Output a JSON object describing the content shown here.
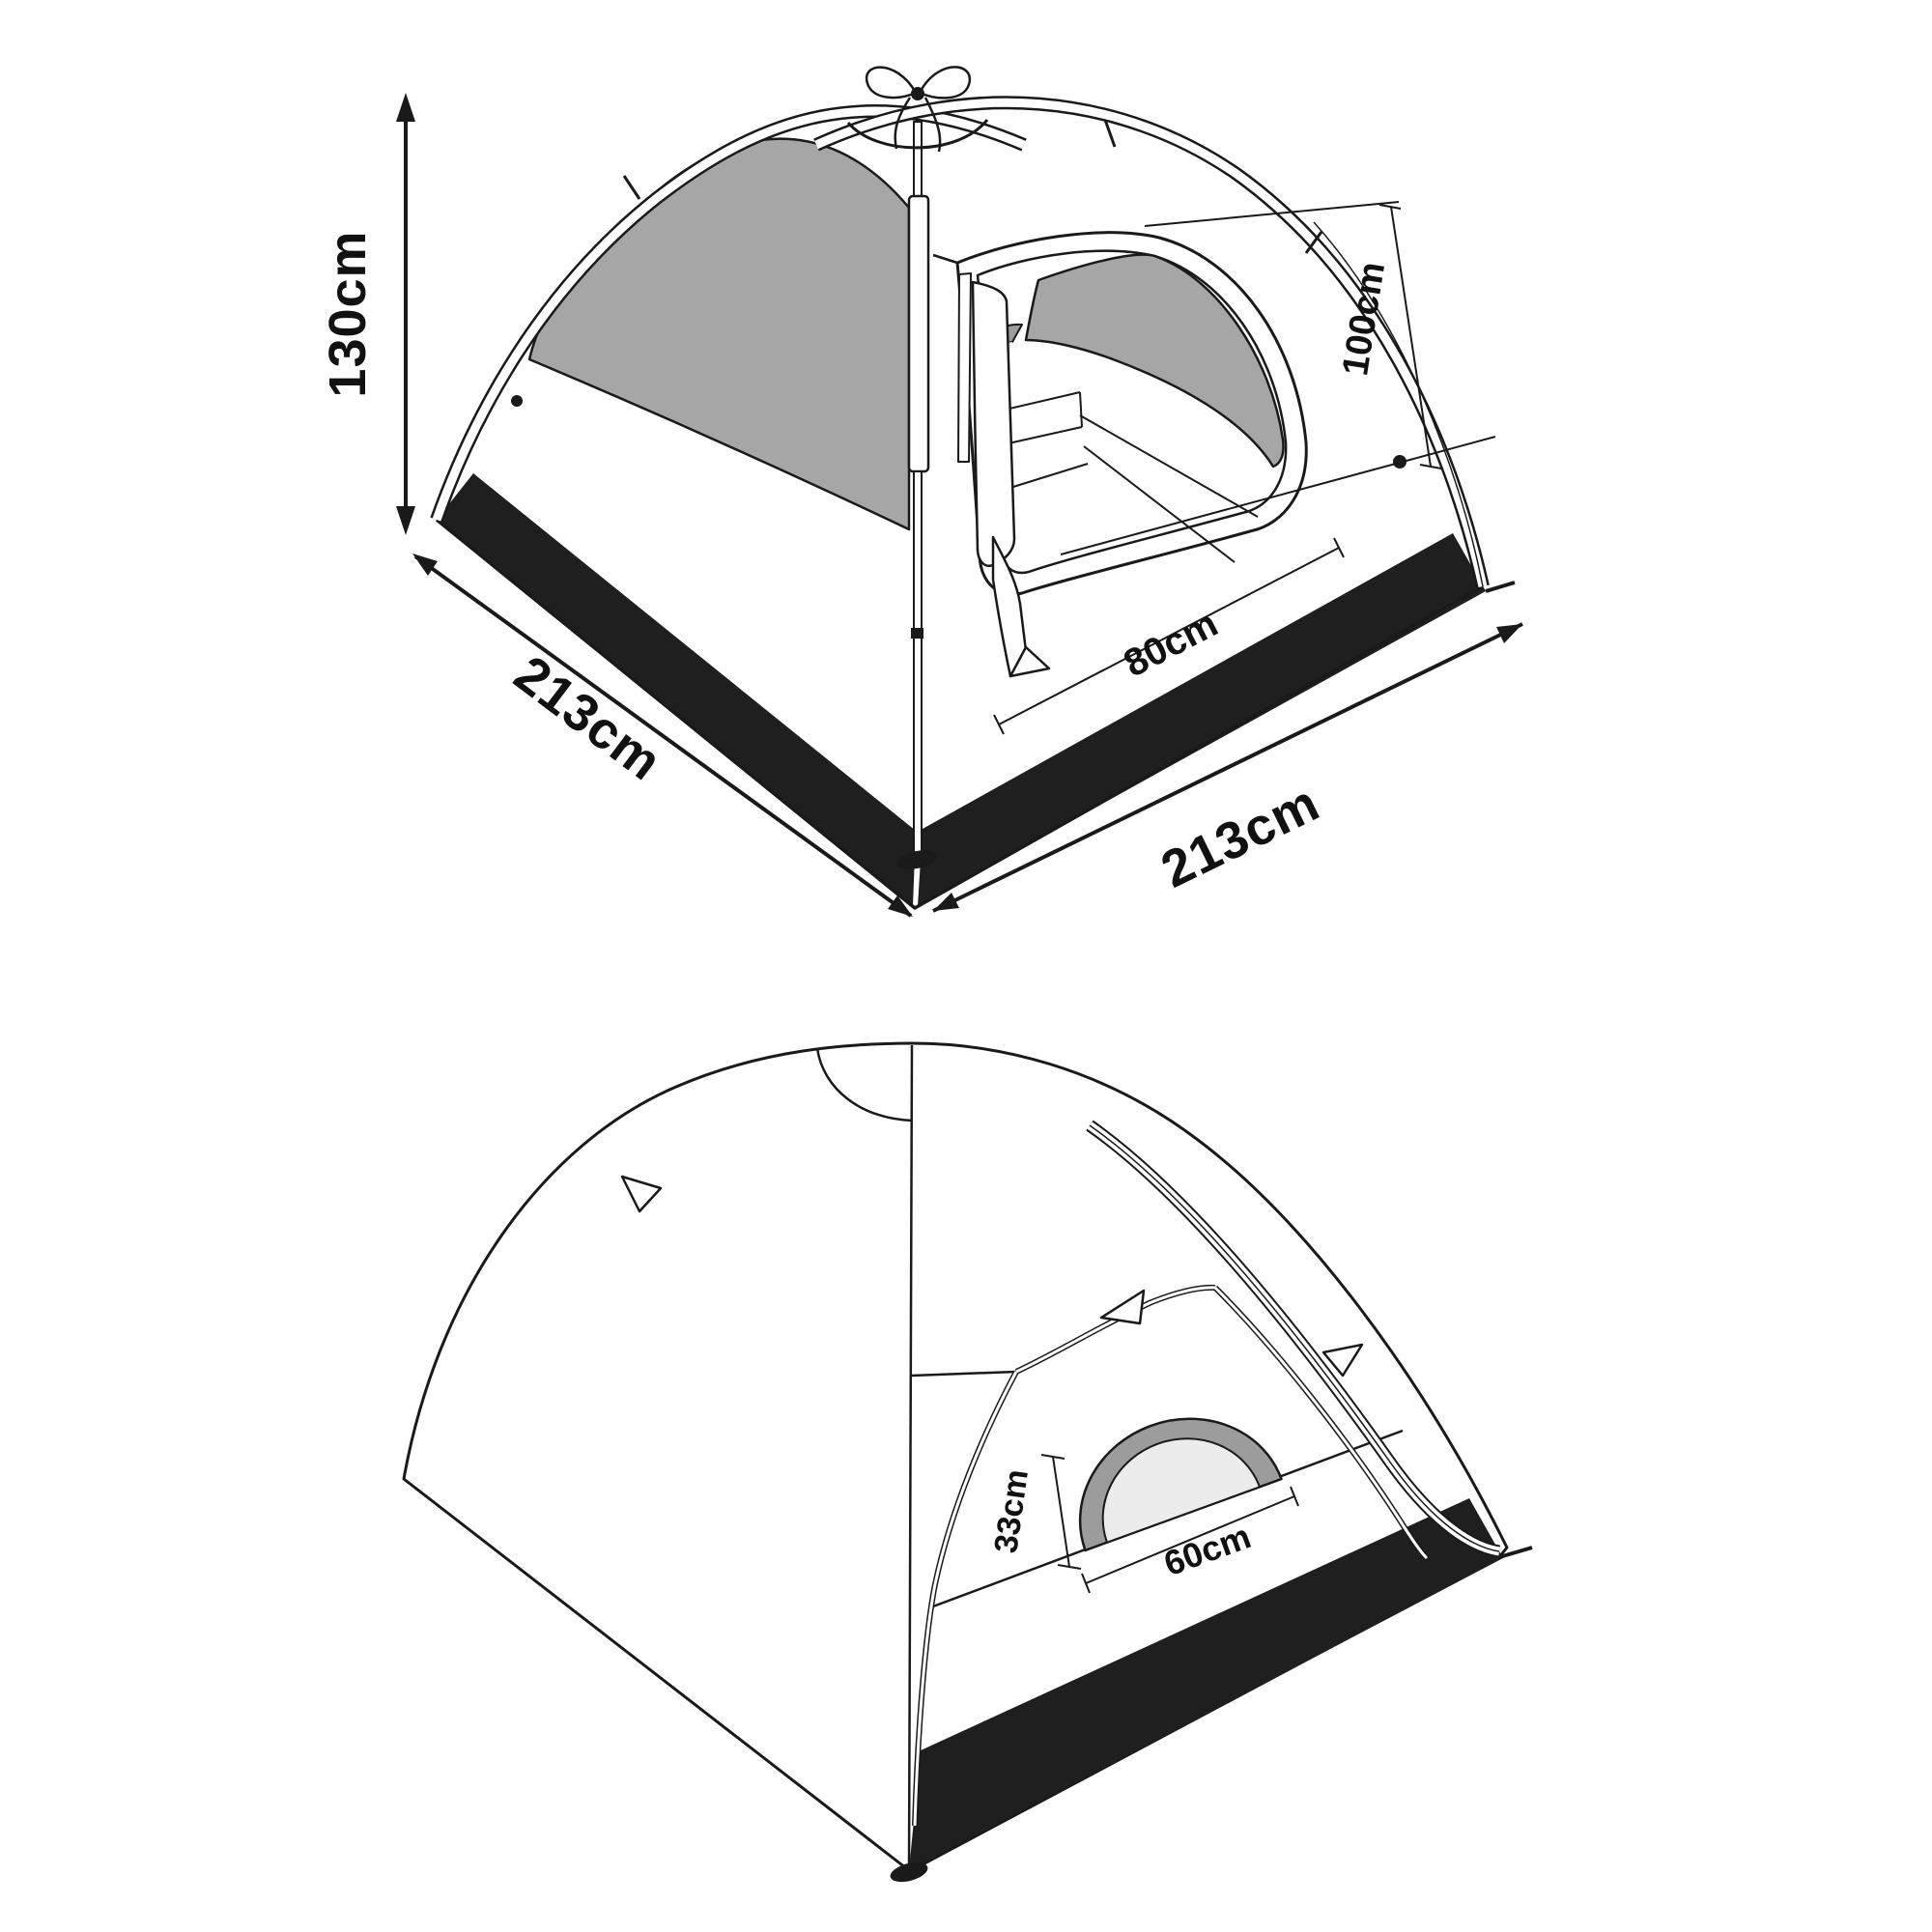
{
  "labels": {
    "height": "130cm",
    "base_left": "213cm",
    "base_right": "213cm",
    "door_height": "100cm",
    "door_width": "80cm",
    "window_height": "33cm",
    "window_width": "60cm"
  },
  "colors": {
    "line": "#1a1a1a",
    "fly_gray": "#a6a6a6",
    "mesh_gray": "#a6a6a6",
    "window_ring_gray": "#9c9c9c",
    "window_inner_gray": "#ececec",
    "skirt_black": "#1f1f1f",
    "background": "#ffffff"
  }
}
